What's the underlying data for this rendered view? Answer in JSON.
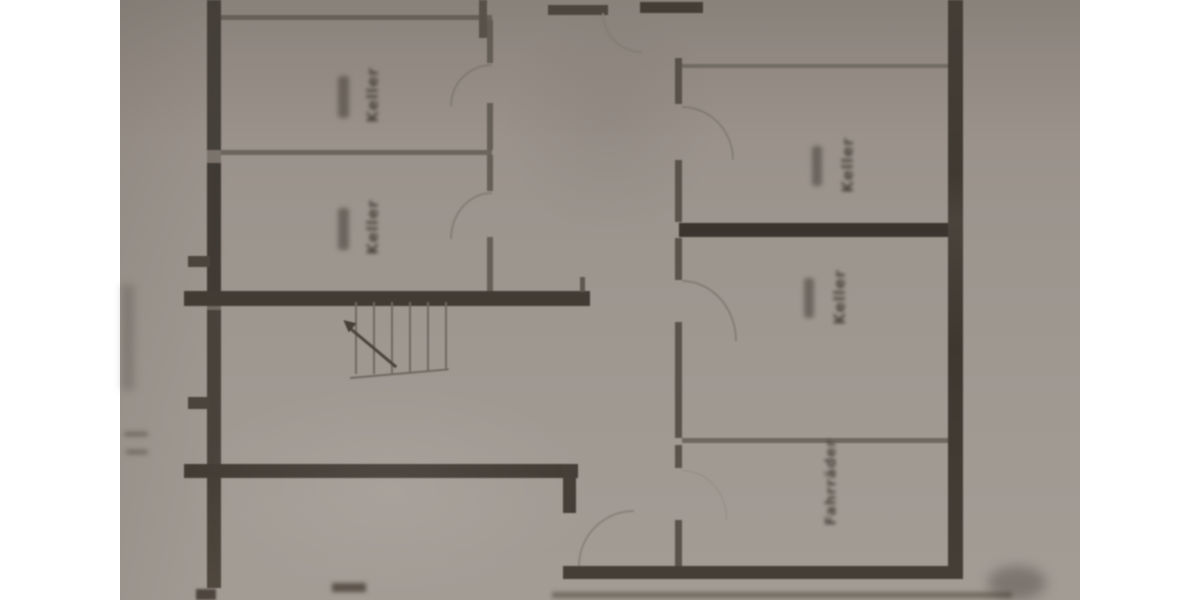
{
  "floor_plan": {
    "type": "basement floor plan (photographed drawing)",
    "labels": {
      "left_room_1": "Keller",
      "left_room_2": "Keller",
      "right_room_1": "Keller",
      "right_room_2": "Keller",
      "bike_room": "Fahrräder"
    },
    "stairs": {
      "tread_count": 6,
      "direction_arrow": "up-left"
    },
    "colors": {
      "canvas": "#ffffff",
      "paper": "#9c958e",
      "wall_thick": "#443d36",
      "wall_thin": "#6b655d",
      "door_arc": "#8a8279",
      "text": "#4a433c"
    }
  }
}
